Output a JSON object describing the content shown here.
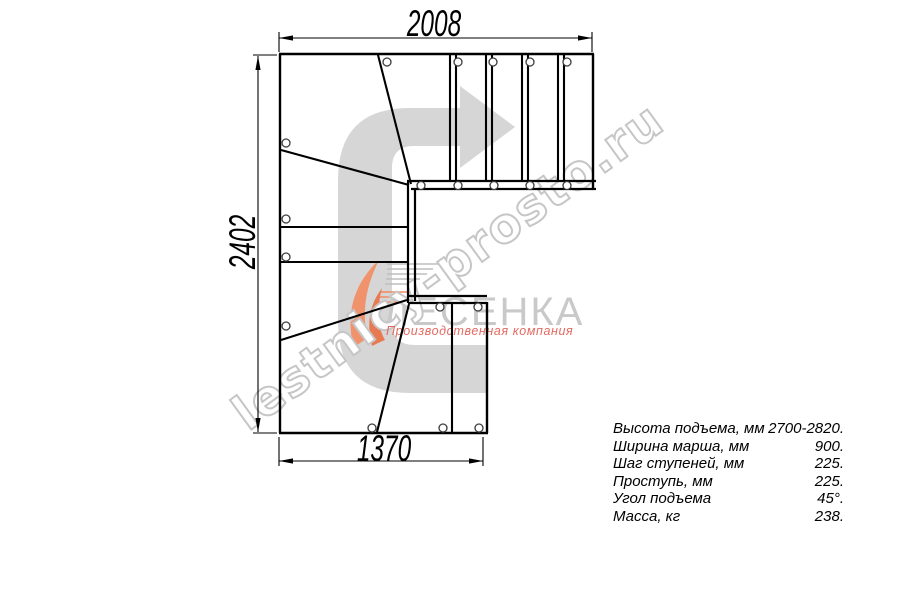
{
  "dimensions": {
    "top": "2008",
    "left": "2402",
    "bottom": "1370"
  },
  "specs": {
    "rows": [
      {
        "label": "Высота подъема, мм",
        "value": "2700-2820."
      },
      {
        "label": "Ширина марша, мм",
        "value": "900."
      },
      {
        "label": "Шаг ступеней, мм",
        "value": "225."
      },
      {
        "label": "Проступь, мм",
        "value": "225."
      },
      {
        "label": "Угол подъема",
        "value": "45°."
      },
      {
        "label": "Масса, кг",
        "value": "238."
      }
    ]
  },
  "watermark": {
    "site": "lestnicy-prosto.ru"
  },
  "logo": {
    "brand": "ЛЕСЕНКА",
    "tagline": "Производственная компания"
  },
  "colors": {
    "drawing_line": "#000000",
    "arrow_watermark": "#d6d6d6",
    "watermark_outline": "#c6c6c6",
    "logo_gray": "#c9c9c9",
    "logo_orange": "#ef8a5f",
    "tagline_red": "#e36a62"
  }
}
